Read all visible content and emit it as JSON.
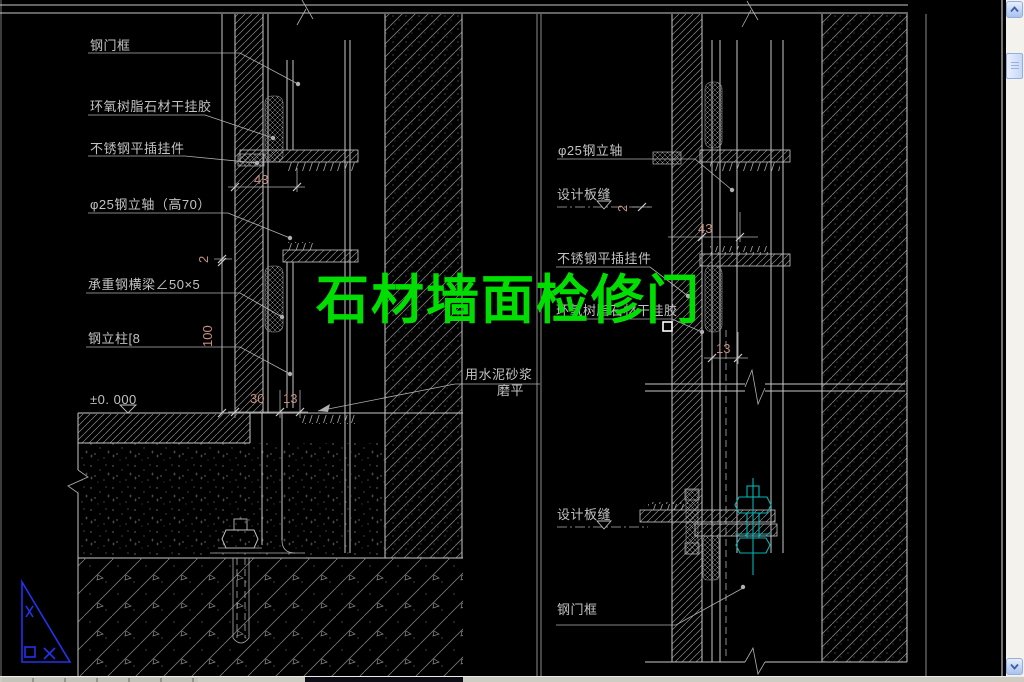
{
  "title": {
    "text": "石材墙面检修门"
  },
  "left": {
    "labels": [
      "钢门框",
      "环氧树脂石材干挂胶",
      "不锈钢平插挂件",
      "φ25钢立轴（高70）",
      "承重钢横梁∠50×5",
      "钢立柱[8",
      "±0. 000"
    ],
    "mortar": [
      "用水泥砂浆",
      "磨平"
    ],
    "dims": {
      "d43": "43",
      "d2": "2",
      "d100": "100",
      "d30": "30",
      "d13": "13"
    }
  },
  "right": {
    "labels": [
      "φ25钢立轴",
      "设计板缝",
      "不锈钢平插挂件",
      "环氧树脂石材干挂胶",
      "设计板缝",
      "钢门框"
    ],
    "dims": {
      "d2": "2",
      "d43": "43",
      "d13": "13"
    }
  },
  "colors": {
    "background": "#000000",
    "title_green": "#00dd00",
    "dimension_text": "#c49080",
    "line_grey": "#c8c8c8",
    "bolt_cyan": "#00b5b5",
    "triangle_blue": "#2233ee",
    "scrollbar_track": "#f4f2ec"
  }
}
